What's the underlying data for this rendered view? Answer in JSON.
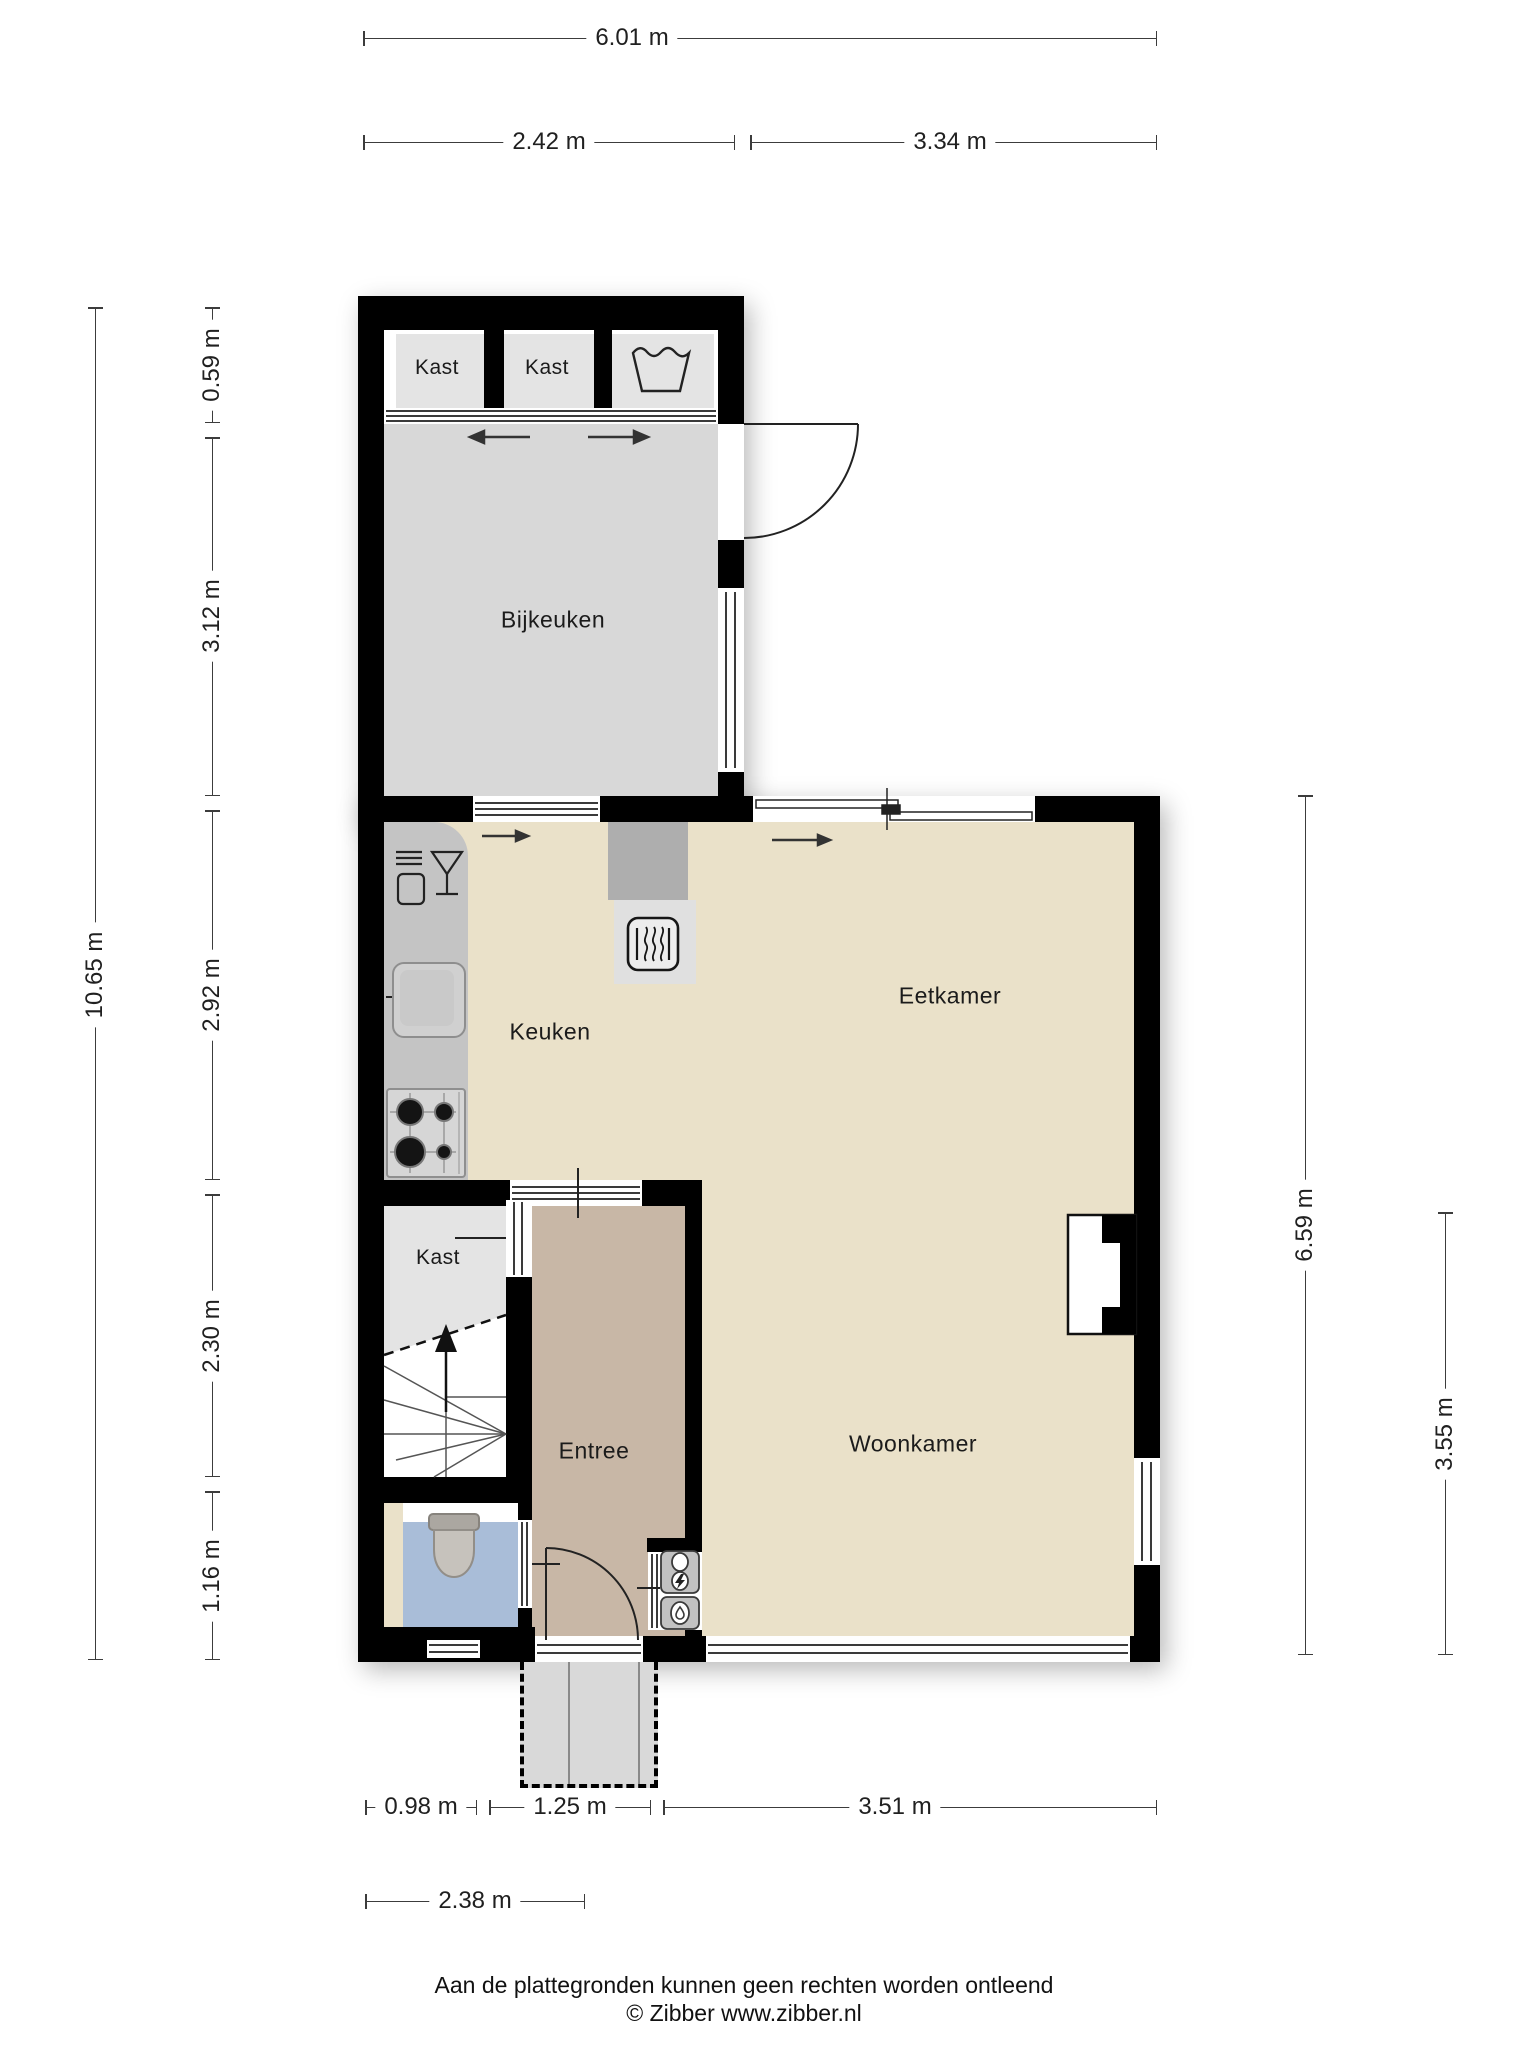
{
  "document_type": "floorplan",
  "rooms": {
    "kast_top_1": "Kast",
    "kast_top_2": "Kast",
    "bijkeuken": "Bijkeuken",
    "keuken": "Keuken",
    "eetkamer": "Eetkamer",
    "kast_hal": "Kast",
    "entree": "Entree",
    "woonkamer": "Woonkamer"
  },
  "dimensions": {
    "top_total": "6.01 m",
    "top_left": "2.42 m",
    "top_right": "3.34 m",
    "left_total": "10.65 m",
    "left_a": "0.59 m",
    "left_b": "3.12 m",
    "left_c": "2.92 m",
    "left_d": "2.30 m",
    "left_e": "1.16 m",
    "right_total": "6.59 m",
    "right_lower": "3.55 m",
    "bottom_a": "0.98 m",
    "bottom_b": "1.25 m",
    "bottom_c": "3.51 m",
    "bottom_total": "2.38 m"
  },
  "fixtures": [
    "washing-machine",
    "sliding-door",
    "dishwasher",
    "sink",
    "stove",
    "heater",
    "stairs-up",
    "toilet",
    "electricity-meter",
    "water-meter",
    "door-swing",
    "chimney-niche"
  ],
  "colors": {
    "wall": "#000000",
    "floor_service": "#d8d8d8",
    "floor_living": "#eae1c9",
    "floor_hall": "#c8b7a6",
    "floor_wc": "#a9bdd8",
    "floor_closet": "#e4e4e4",
    "counter": "#c4c4c4",
    "chimney": "#aeaeae",
    "porch": "#d9d9d9",
    "dimension_line": "#3c3c3c"
  },
  "footer": {
    "disclaimer": "Aan de plattegronden kunnen geen rechten worden ontleend",
    "copyright": "© Zibber www.zibber.nl"
  }
}
